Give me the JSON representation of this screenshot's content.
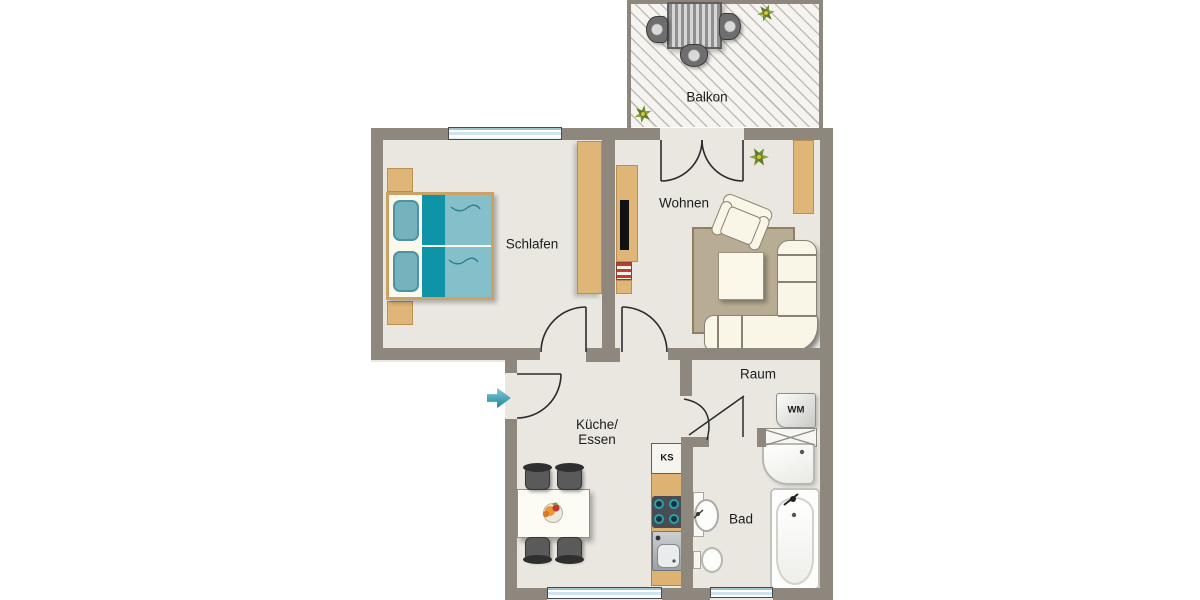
{
  "page": {
    "type": "apartment-floor-plan"
  },
  "rooms": {
    "balkon": {
      "label": "Balkon"
    },
    "schlafen": {
      "label": "Schlafen"
    },
    "wohnen": {
      "label": "Wohnen"
    },
    "kueche": {
      "line1": "Küche/",
      "line2": "Essen"
    },
    "raum": {
      "label": "Raum"
    },
    "bad": {
      "label": "Bad"
    }
  },
  "appliances": {
    "kuehlschrank": {
      "label": "KS"
    },
    "waschmaschine": {
      "label": "WM"
    }
  },
  "icons": {
    "entry_arrow": "entry-direction-arrow",
    "plant": "plant-icon",
    "door_swing": "door-swing-arc",
    "crossed_shelf": "shelf-crossed-box"
  },
  "colors": {
    "wall": "#8e877e",
    "floor": "#eae7e1",
    "wood_furniture": "#e0b678",
    "bed_blanket": "#85bfc9",
    "bed_blanket_dark": "#0f93a7",
    "bed_pillow": "#74b2bd",
    "rug": "#b9ac94",
    "sofa": "#faf6e7",
    "entry_arrow": "#2293ab",
    "plant_green": "#6e8f2e",
    "radiator_red": "#c23b2e",
    "window_blue": "#cfe4ee"
  }
}
